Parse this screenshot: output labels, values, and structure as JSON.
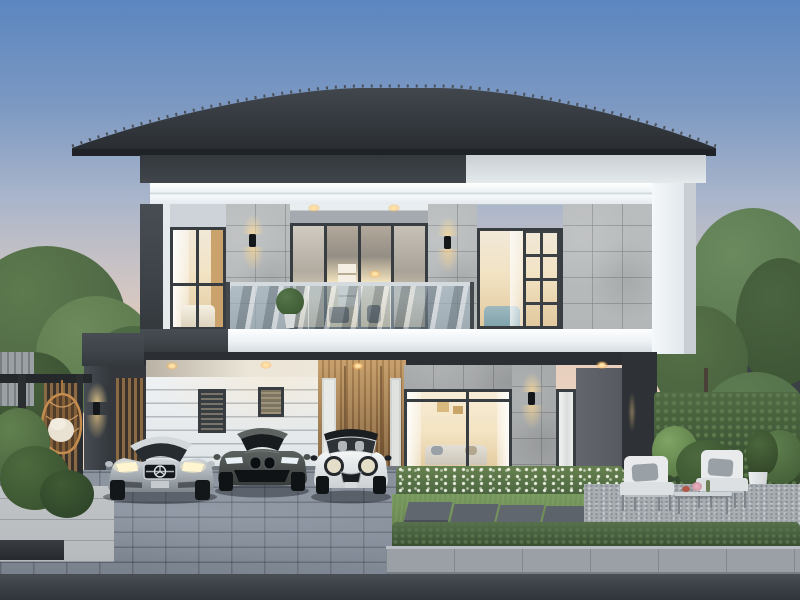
{
  "scene": {
    "title": "Twilight rendering of a modern two-storey house with carport, balcony and landscaped yard",
    "time_of_day": "dusk",
    "style": "modern contemporary two-storey residence"
  },
  "colors": {
    "skyTop": "#5b86c0",
    "skyHorizon": "#e7cdbc",
    "roofLight": "#3e444a",
    "roofDark": "#24282c",
    "charcoal": "#3e4349",
    "charcoalDeep": "#2b2f33",
    "fasciaWhite": "#f4f8fa",
    "wallWhite": "#e9edef",
    "stone": "#b4b7b8",
    "frameDark": "#383d41",
    "interiorWarm": "#f3e2bf",
    "glowWarm": "#ffd98f",
    "wood": "#a87c50",
    "grass": "#6b8a53",
    "hedge": "#42593b",
    "treeMid": "#4e6845",
    "treeLight": "#5d7a4e",
    "treeDark": "#3c5233",
    "paver": "#79818d",
    "street": "#3e434a",
    "sidewalk": "#9aa0a6",
    "gravel": "#a8adb2",
    "concrete": "#b6babd",
    "carSilver": "#c0c6cb",
    "carBmwGrey": "#4b504d",
    "carMiniWhite": "#e7eaec",
    "rattan": "#c48c4e",
    "cushion": "#e9e2d3"
  },
  "objects": {
    "house": "Modern two-storey house with dark hip roof, white frame band, grey stone tile walls",
    "roof": "Dark charcoal tiled hip roof",
    "balcony": "Second-floor balcony with glass railing and potted plant",
    "carLeft": "Silver Mercedes-Benz sedan with headlights on",
    "carMiddle": "Dark grey BMW sedan",
    "carRight": "White Mini Cooper with black roof",
    "carport": "Charcoal carport with white grooved back wall and warm downlights",
    "frontDoor": "Vertical wood slat entrance door",
    "livingWindow": "Large ground-floor living room window with warm lit interior",
    "hangingChair": "Rattan hanging egg chair with white cushion",
    "patioSet": "Outdoor lounge armchairs with glass coffee table and white planter",
    "drive": "Grey block-paved driveway",
    "garden": "Landscaped garden with hedges, lawn and stepping stones"
  }
}
